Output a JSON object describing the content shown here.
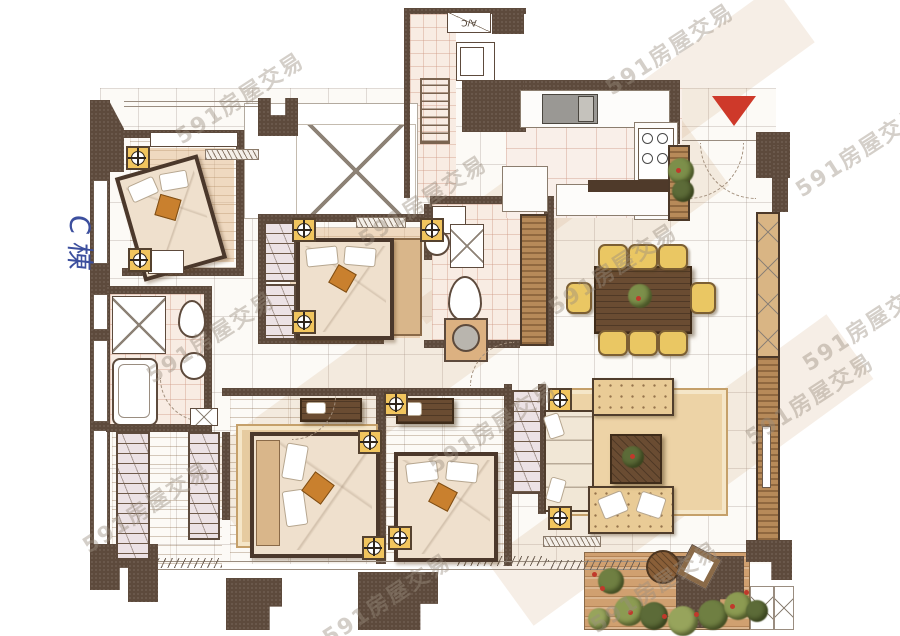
{
  "labels": {
    "ac": "A/C",
    "building": "C棟"
  },
  "watermark": {
    "text": "591房屋交易",
    "color": "rgba(152,140,127,0.42)",
    "positions": [
      [
        225,
        95
      ],
      [
        655,
        46
      ],
      [
        408,
        198
      ],
      [
        845,
        148
      ],
      [
        598,
        266
      ],
      [
        852,
        322
      ],
      [
        196,
        334
      ],
      [
        478,
        424
      ],
      [
        795,
        396
      ],
      [
        372,
        596
      ],
      [
        640,
        584
      ],
      [
        132,
        504
      ]
    ]
  },
  "markers": {
    "entrance_triangle_color": "#ce392a",
    "column_color": "#f1c55e",
    "columns": [
      [
        126,
        146
      ],
      [
        128,
        248
      ],
      [
        292,
        218
      ],
      [
        292,
        310
      ],
      [
        420,
        218
      ],
      [
        384,
        392
      ],
      [
        358,
        430
      ],
      [
        362,
        536
      ],
      [
        388,
        526
      ],
      [
        548,
        388
      ],
      [
        548,
        506
      ]
    ]
  },
  "dining": {
    "chair_color": "#eac763",
    "chairs": [
      [
        598,
        244,
        26,
        22
      ],
      [
        628,
        244,
        26,
        22
      ],
      [
        658,
        244,
        26,
        22
      ],
      [
        598,
        330,
        26,
        22
      ],
      [
        628,
        330,
        26,
        22
      ],
      [
        658,
        330,
        26,
        22
      ],
      [
        566,
        282,
        22,
        28
      ],
      [
        690,
        282,
        22,
        28
      ]
    ]
  },
  "garden": {
    "shrub_colors": [
      "#6f7f42",
      "#8c9b52",
      "#5c6b38",
      "#97a45c"
    ],
    "shrubs": [
      [
        598,
        568,
        13
      ],
      [
        614,
        596,
        15
      ],
      [
        640,
        602,
        14
      ],
      [
        668,
        606,
        15
      ],
      [
        698,
        600,
        15
      ],
      [
        724,
        592,
        14
      ],
      [
        746,
        600,
        11
      ],
      [
        588,
        608,
        11
      ]
    ],
    "flower_color": "#c0392b",
    "flowers": [
      [
        600,
        586
      ],
      [
        628,
        610
      ],
      [
        662,
        614
      ],
      [
        694,
        612
      ],
      [
        730,
        604
      ],
      [
        592,
        572
      ],
      [
        744,
        590
      ]
    ]
  },
  "palette": {
    "wall": "#5d4a3c",
    "wood_floor": "#d5a875",
    "tile_pink": "#f8ece3",
    "accent_red": "#ce392a",
    "handwriting_blue": "#3c4f9e"
  }
}
